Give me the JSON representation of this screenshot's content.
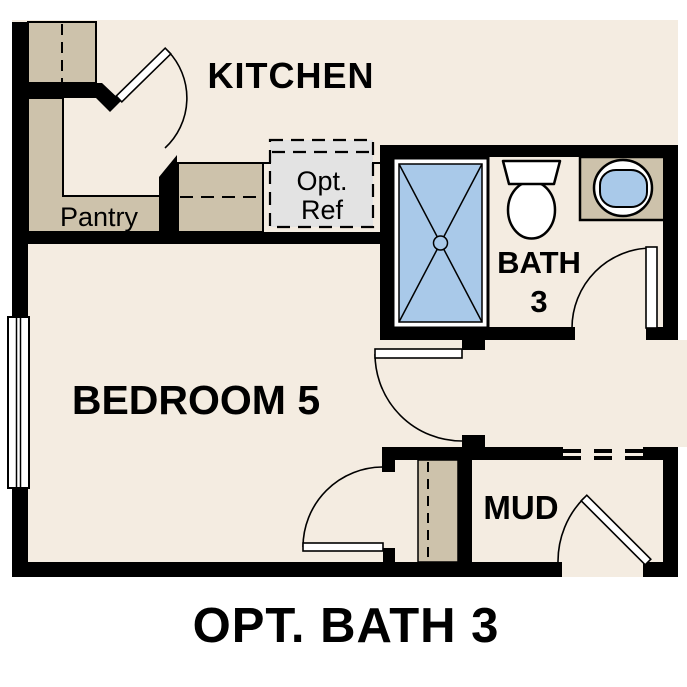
{
  "title": "OPT. BATH 3",
  "rooms": {
    "kitchen": {
      "label": "KITCHEN"
    },
    "pantry": {
      "label": "Pantry"
    },
    "bath": {
      "label_line1": "BATH",
      "label_line2": "3"
    },
    "bedroom": {
      "label": "BEDROOM 5"
    },
    "mud": {
      "label": "MUD"
    }
  },
  "annotations": {
    "opt_ref_line1": "Opt.",
    "opt_ref_line2": "Ref"
  },
  "colors": {
    "background": "#ffffff",
    "floor": "#f4ece1",
    "wall": "#000000",
    "counter": "#cdc2ab",
    "fixture_blue": "#a9c9e9",
    "opt_ref_gray": "#e3e3e3"
  }
}
